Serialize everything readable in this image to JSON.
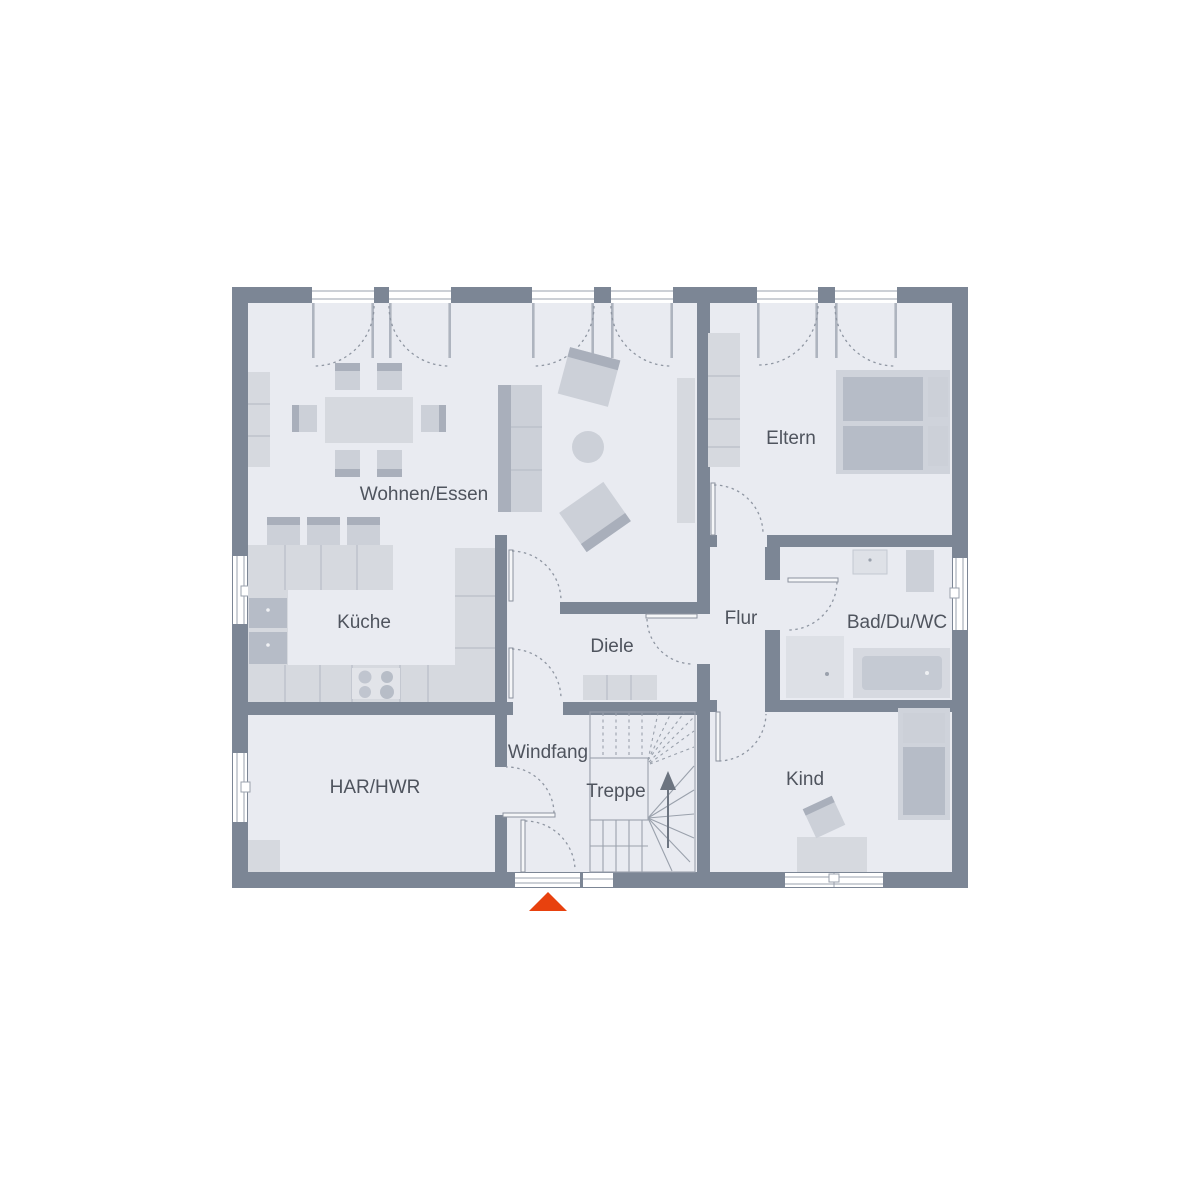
{
  "plan": {
    "type": "floor-plan",
    "rooms": [
      {
        "id": "wohnen-essen",
        "label": "Wohnen/Essen"
      },
      {
        "id": "kueche",
        "label": "Küche"
      },
      {
        "id": "eltern",
        "label": "Eltern"
      },
      {
        "id": "flur",
        "label": "Flur"
      },
      {
        "id": "bad-du-wc",
        "label": "Bad/Du/WC"
      },
      {
        "id": "diele",
        "label": "Diele"
      },
      {
        "id": "windfang",
        "label": "Windfang"
      },
      {
        "id": "treppe",
        "label": "Treppe"
      },
      {
        "id": "har-hwr",
        "label": "HAR/HWR"
      },
      {
        "id": "kind",
        "label": "Kind"
      }
    ],
    "entrance": {
      "marker_color": "#e8410e"
    },
    "colors": {
      "wall": "#7c8695",
      "floor": "#e9ebf1",
      "furniture": "#ccd0d8",
      "accent": "#a9afbb",
      "label_text": "#4f545e"
    }
  }
}
